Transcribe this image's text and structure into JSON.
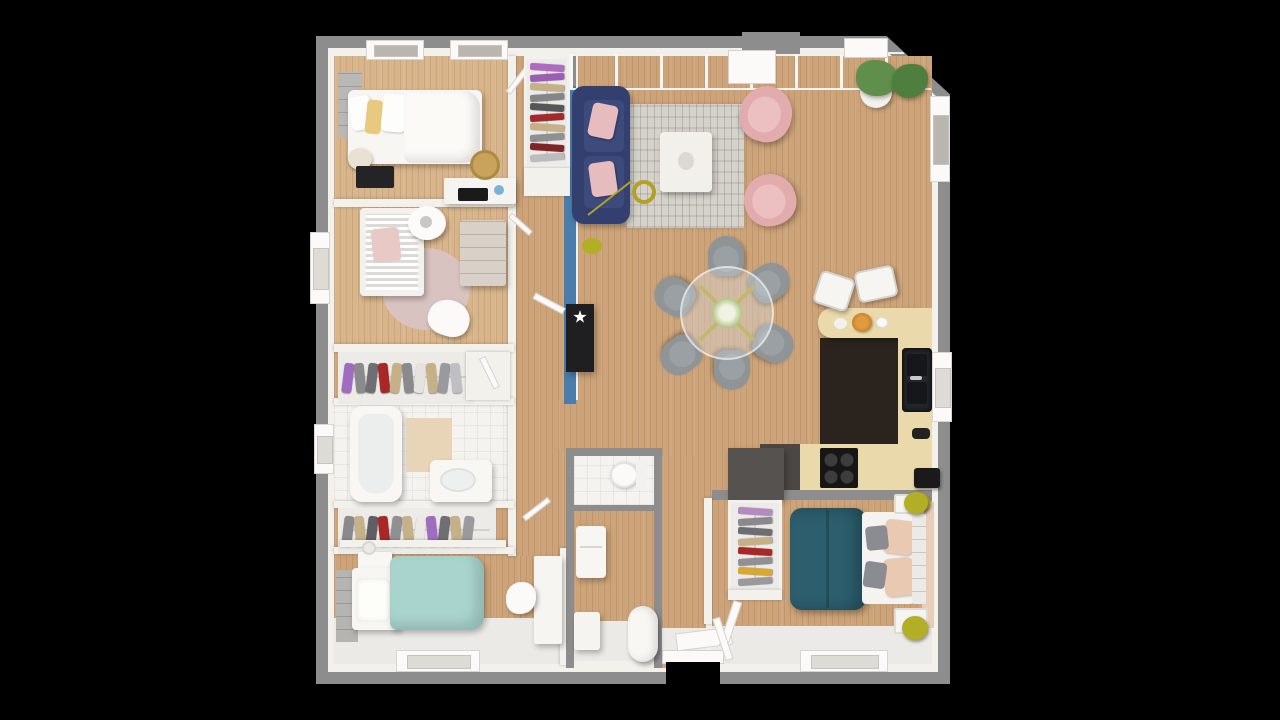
{
  "scene": {
    "description": "3D top-down architectural render of a single-storey house floor plan on a black background",
    "background": "#000000"
  },
  "palette": {
    "background": "#000000",
    "exterior_wall": "#8d8d8d",
    "interior_wall": "#f3f1ec",
    "wall_peach": "#e9cdb8",
    "accent_wall_blue": "#4b7dac",
    "wood_floor": "#cda47a",
    "wood_floor_light": "#d9b58c",
    "tile_floor": "#f4f3f0",
    "kitchen_dark_floor": "#2b241e",
    "counter_wood": "#ead9ab",
    "counter_dark": "#4a4744",
    "cooktop_black": "#161616",
    "sink_black": "#23262a",
    "sofa_navy": "#33406f",
    "sofa_cushion": "#3c4a7c",
    "cushion_pink": "#e6bcbe",
    "armchair_pink": "#e2abad",
    "rug_gray": "#d5d2ca",
    "table_white": "#f2f0eb",
    "gold": "#b3a125",
    "olive": "#b2ae26",
    "dining_chair_gray": "#8f9497",
    "duvet_teal": "#2c5e6d",
    "duvet_seafoam": "#a9d4cd",
    "pillow_peach": "#eac9b2",
    "pillow_yellow": "#e9c87f",
    "pillow_gray": "#8b8b92",
    "nursery_rug_pink": "#d9c3c0",
    "crib_blanket_pink": "#e8c9c6",
    "plant_green": "#5f8f4a",
    "plant_green_dark": "#4e7f3e",
    "rattan": "#c9a25c",
    "lamp_cream": "#e9e2d2",
    "console_black": "#1f1f22"
  },
  "closets": {
    "hall_wardrobe": [
      "#b06ac2",
      "#9a5fb5",
      "#c5b088",
      "#85858a",
      "#55555a",
      "#a32a2a",
      "#c5b088",
      "#8f8f94",
      "#7e2626",
      "#bcbcc0"
    ],
    "corridor_rack_upper": [
      "#a06cc0",
      "#8a8a8e",
      "#6f6f73",
      "#a82828",
      "#c5b088",
      "#8a8a8e",
      "#e6e3de",
      "#c5b088",
      "#9a9a9e",
      "#bfbfc3"
    ],
    "corridor_rack_lower": [
      "#8a8a8e",
      "#c5b088",
      "#5f5f63",
      "#a82828",
      "#8f8f94",
      "#c5b088",
      "#ece9e4",
      "#a06cc0",
      "#6f6f73",
      "#c5b088",
      "#9a9a9e"
    ],
    "master_wardrobe": [
      "#b48ac0",
      "#8a8a8e",
      "#6e6e72",
      "#c5b088",
      "#a82828",
      "#8f8f94",
      "#d8a832",
      "#9a9a9e"
    ]
  },
  "rooms": [
    {
      "id": "bedroom-1",
      "furniture": [
        "double-bed",
        "white-pillows",
        "yellow-pillow",
        "black-nightstand",
        "cream-lamp",
        "headboard-panel",
        "desk",
        "laptop",
        "rattan-chair"
      ]
    },
    {
      "id": "nursery",
      "furniture": [
        "crib",
        "pink-blanket",
        "round-pendant-lamp",
        "pink-round-rug",
        "dresser",
        "white-chair"
      ]
    },
    {
      "id": "wardrobe-corridor-upper",
      "furniture": [
        "clothes-rack",
        "open-door"
      ]
    },
    {
      "id": "bathroom",
      "furniture": [
        "bathtub",
        "bath-mat",
        "vanity-sink"
      ]
    },
    {
      "id": "wardrobe-corridor-lower",
      "furniture": [
        "clothes-rack",
        "shelf"
      ]
    },
    {
      "id": "bedroom-2",
      "furniture": [
        "single-bed-seafoam",
        "textured-pillow",
        "nightstand",
        "lamp",
        "headboard-panel",
        "desk",
        "chair"
      ]
    },
    {
      "id": "hallway",
      "furniture": [
        "hall-wardrobe",
        "blue-accent-wall",
        "black-console",
        "star-decor",
        "doors"
      ]
    },
    {
      "id": "living-room",
      "furniture": [
        "navy-sofa",
        "pink-cushions",
        "gray-rug",
        "marble-coffee-table",
        "gold-arc-lamp",
        "pink-armchair-1",
        "pink-armchair-2",
        "potted-plants",
        "glass-wall"
      ]
    },
    {
      "id": "dining-area",
      "furniture": [
        "round-glass-table",
        "gold-cross-legs",
        "bouquet",
        "six-gray-chairs"
      ]
    },
    {
      "id": "kitchen",
      "furniture": [
        "u-shaped-wood-counter",
        "two-white-bar-stools",
        "breakfast-plates",
        "pastry-bowl",
        "black-double-sink",
        "four-burner-cooktop",
        "dark-counter-section",
        "coffee-machine",
        "yellow-stool"
      ]
    },
    {
      "id": "wc",
      "furniture": [
        "toilet",
        "paper-roll"
      ]
    },
    {
      "id": "laundry-entry",
      "furniture": [
        "washing-machine",
        "bench",
        "laundry-basket-cylinder",
        "front-door-open"
      ]
    },
    {
      "id": "master-bedroom",
      "furniture": [
        "wardrobe-dark-cabinet",
        "clothes-rack",
        "double-bed-teal",
        "peach-pillows",
        "gray-pillows",
        "slatted-headboard",
        "wire-nightstands",
        "olive-poufs",
        "open-door",
        "peach-wall"
      ]
    }
  ]
}
